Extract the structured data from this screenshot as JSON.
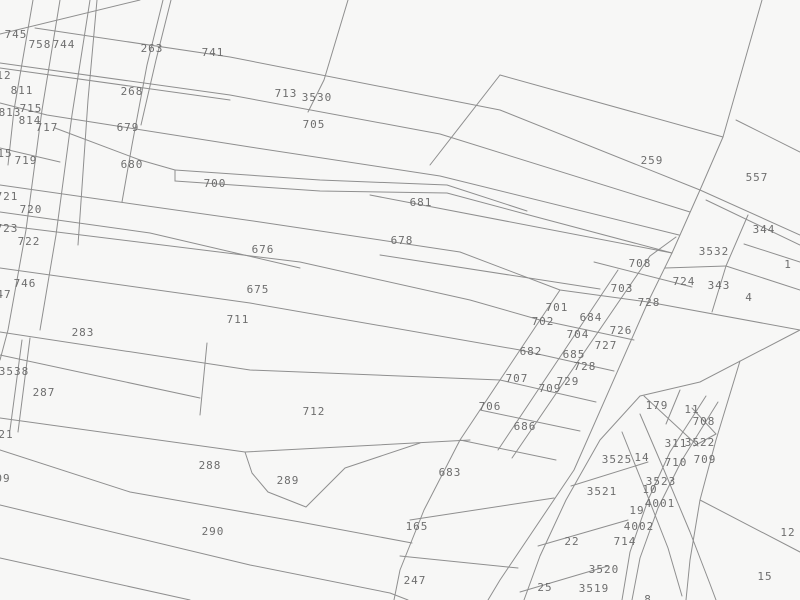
{
  "map": {
    "type": "cadastral-parcel-map",
    "colors": {
      "background": "#f7f7f6",
      "line": "#8f8f8f",
      "label": "#6e6e6e"
    },
    "labels": [
      {
        "t": "745",
        "x": 16,
        "y": 34
      },
      {
        "t": "758",
        "x": 40,
        "y": 44
      },
      {
        "t": "744",
        "x": 64,
        "y": 44
      },
      {
        "t": "12",
        "x": 4,
        "y": 75
      },
      {
        "t": "811",
        "x": 22,
        "y": 90
      },
      {
        "t": "715",
        "x": 31,
        "y": 108
      },
      {
        "t": "813",
        "x": 10,
        "y": 112
      },
      {
        "t": "814",
        "x": 30,
        "y": 120
      },
      {
        "t": "717",
        "x": 47,
        "y": 127
      },
      {
        "t": "263",
        "x": 152,
        "y": 48
      },
      {
        "t": "741",
        "x": 213,
        "y": 52
      },
      {
        "t": "268",
        "x": 132,
        "y": 91
      },
      {
        "t": "679",
        "x": 128,
        "y": 127
      },
      {
        "t": "713",
        "x": 286,
        "y": 93
      },
      {
        "t": "3530",
        "x": 317,
        "y": 97
      },
      {
        "t": "705",
        "x": 314,
        "y": 124
      },
      {
        "t": "15",
        "x": 5,
        "y": 153
      },
      {
        "t": "719",
        "x": 26,
        "y": 160
      },
      {
        "t": "680",
        "x": 132,
        "y": 164
      },
      {
        "t": "700",
        "x": 215,
        "y": 183
      },
      {
        "t": "721",
        "x": 7,
        "y": 196
      },
      {
        "t": "720",
        "x": 31,
        "y": 209
      },
      {
        "t": "723",
        "x": 7,
        "y": 228
      },
      {
        "t": "722",
        "x": 29,
        "y": 241
      },
      {
        "t": "746",
        "x": 25,
        "y": 283
      },
      {
        "t": "47",
        "x": 4,
        "y": 294
      },
      {
        "t": "681",
        "x": 421,
        "y": 202
      },
      {
        "t": "678",
        "x": 402,
        "y": 240
      },
      {
        "t": "676",
        "x": 263,
        "y": 249
      },
      {
        "t": "675",
        "x": 258,
        "y": 289
      },
      {
        "t": "711",
        "x": 238,
        "y": 319
      },
      {
        "t": "283",
        "x": 83,
        "y": 332
      },
      {
        "t": "3538",
        "x": 14,
        "y": 371
      },
      {
        "t": "287",
        "x": 44,
        "y": 392
      },
      {
        "t": "259",
        "x": 652,
        "y": 160
      },
      {
        "t": "557",
        "x": 757,
        "y": 177
      },
      {
        "t": "344",
        "x": 764,
        "y": 229
      },
      {
        "t": "3532",
        "x": 714,
        "y": 251
      },
      {
        "t": "708",
        "x": 640,
        "y": 263
      },
      {
        "t": "1",
        "x": 788,
        "y": 264
      },
      {
        "t": "724",
        "x": 684,
        "y": 281
      },
      {
        "t": "703",
        "x": 622,
        "y": 288
      },
      {
        "t": "343",
        "x": 719,
        "y": 285
      },
      {
        "t": "4",
        "x": 749,
        "y": 297
      },
      {
        "t": "728",
        "x": 649,
        "y": 302
      },
      {
        "t": "701",
        "x": 557,
        "y": 307
      },
      {
        "t": "684",
        "x": 591,
        "y": 317
      },
      {
        "t": "702",
        "x": 543,
        "y": 321
      },
      {
        "t": "726",
        "x": 621,
        "y": 330
      },
      {
        "t": "704",
        "x": 578,
        "y": 334
      },
      {
        "t": "727",
        "x": 606,
        "y": 345
      },
      {
        "t": "682",
        "x": 531,
        "y": 351
      },
      {
        "t": "685",
        "x": 574,
        "y": 354
      },
      {
        "t": "728",
        "x": 585,
        "y": 366
      },
      {
        "t": "707",
        "x": 517,
        "y": 378
      },
      {
        "t": "729",
        "x": 568,
        "y": 381
      },
      {
        "t": "709",
        "x": 550,
        "y": 388
      },
      {
        "t": "706",
        "x": 490,
        "y": 406
      },
      {
        "t": "686",
        "x": 525,
        "y": 426
      },
      {
        "t": "712",
        "x": 314,
        "y": 411
      },
      {
        "t": "288",
        "x": 210,
        "y": 465
      },
      {
        "t": "289",
        "x": 288,
        "y": 480
      },
      {
        "t": "683",
        "x": 450,
        "y": 472
      },
      {
        "t": "290",
        "x": 213,
        "y": 531
      },
      {
        "t": "165",
        "x": 417,
        "y": 526
      },
      {
        "t": "247",
        "x": 415,
        "y": 580
      },
      {
        "t": "21",
        "x": 6,
        "y": 434
      },
      {
        "t": "09",
        "x": 3,
        "y": 478
      },
      {
        "t": "179",
        "x": 657,
        "y": 405
      },
      {
        "t": "11",
        "x": 692,
        "y": 409
      },
      {
        "t": "708",
        "x": 704,
        "y": 421
      },
      {
        "t": "311",
        "x": 676,
        "y": 443
      },
      {
        "t": "3522",
        "x": 700,
        "y": 442
      },
      {
        "t": "3525",
        "x": 617,
        "y": 459
      },
      {
        "t": "14",
        "x": 642,
        "y": 457
      },
      {
        "t": "710",
        "x": 676,
        "y": 462
      },
      {
        "t": "709",
        "x": 705,
        "y": 459
      },
      {
        "t": "3523",
        "x": 661,
        "y": 481
      },
      {
        "t": "10",
        "x": 650,
        "y": 489
      },
      {
        "t": "3521",
        "x": 602,
        "y": 491
      },
      {
        "t": "4001",
        "x": 660,
        "y": 503
      },
      {
        "t": "19",
        "x": 637,
        "y": 510
      },
      {
        "t": "4002",
        "x": 639,
        "y": 526
      },
      {
        "t": "22",
        "x": 572,
        "y": 541
      },
      {
        "t": "714",
        "x": 625,
        "y": 541
      },
      {
        "t": "12",
        "x": 788,
        "y": 532
      },
      {
        "t": "3520",
        "x": 604,
        "y": 569
      },
      {
        "t": "15",
        "x": 765,
        "y": 576
      },
      {
        "t": "25",
        "x": 545,
        "y": 587
      },
      {
        "t": "3519",
        "x": 594,
        "y": 588
      },
      {
        "t": "8",
        "x": 648,
        "y": 599
      }
    ],
    "lines": [
      [
        33,
        0,
        14,
        110,
        8,
        165
      ],
      [
        60,
        0,
        42,
        110,
        26,
        230,
        8,
        330,
        0,
        360
      ],
      [
        90,
        0,
        72,
        115,
        56,
        235,
        40,
        330
      ],
      [
        97,
        0,
        88,
        100,
        78,
        245
      ],
      [
        163,
        0,
        147,
        65,
        132,
        145,
        122,
        202
      ],
      [
        171,
        0,
        156,
        60,
        141,
        125
      ],
      [
        348,
        0,
        324,
        80,
        308,
        112
      ],
      [
        0,
        34,
        140,
        0
      ],
      [
        35,
        28,
        230,
        57,
        500,
        110,
        700,
        190
      ],
      [
        0,
        63,
        230,
        95,
        440,
        134,
        690,
        212
      ],
      [
        0,
        68,
        230,
        100
      ],
      [
        0,
        103,
        47,
        115,
        250,
        147,
        440,
        176,
        679,
        235
      ],
      [
        55,
        128,
        140,
        160,
        175,
        170
      ],
      [
        175,
        170,
        320,
        180,
        447,
        185,
        527,
        211
      ],
      [
        175,
        181,
        320,
        191,
        447,
        193,
        529,
        215
      ],
      [
        175,
        170,
        175,
        181
      ],
      [
        529,
        215,
        672,
        253
      ],
      [
        370,
        195,
        672,
        253
      ],
      [
        0,
        148,
        60,
        162
      ],
      [
        0,
        185,
        260,
        222,
        460,
        252,
        560,
        290,
        648,
        302
      ],
      [
        0,
        212,
        150,
        233,
        300,
        268
      ],
      [
        0,
        225,
        300,
        262,
        470,
        300,
        540,
        320,
        634,
        340
      ],
      [
        0,
        268,
        250,
        303,
        520,
        350,
        614,
        371
      ],
      [
        0,
        332,
        250,
        370,
        500,
        380,
        596,
        402
      ],
      [
        380,
        255,
        600,
        289
      ],
      [
        0,
        355,
        200,
        398
      ],
      [
        22,
        340,
        10,
        430
      ],
      [
        30,
        338,
        18,
        432
      ],
      [
        207,
        343,
        200,
        415
      ],
      [
        0,
        418,
        245,
        452,
        470,
        440
      ],
      [
        245,
        452,
        252,
        473,
        268,
        492,
        306,
        507,
        345,
        468,
        420,
        443
      ],
      [
        0,
        450,
        130,
        492,
        300,
        522,
        412,
        543
      ],
      [
        0,
        505,
        250,
        565,
        390,
        593,
        408,
        600
      ],
      [
        0,
        558,
        190,
        600
      ],
      [
        460,
        440,
        424,
        510,
        400,
        570,
        394,
        600
      ],
      [
        410,
        520,
        554,
        498
      ],
      [
        400,
        556,
        518,
        568
      ],
      [
        648,
        302,
        574,
        470,
        500,
        580,
        488,
        600
      ],
      [
        762,
        0,
        723,
        137,
        700,
        190,
        672,
        253,
        648,
        302
      ],
      [
        500,
        75,
        723,
        137
      ],
      [
        500,
        75,
        430,
        165
      ],
      [
        736,
        120,
        800,
        152
      ],
      [
        700,
        190,
        800,
        235
      ],
      [
        706,
        200,
        800,
        245
      ],
      [
        665,
        268,
        726,
        266
      ],
      [
        748,
        215,
        726,
        266,
        712,
        312
      ],
      [
        726,
        266,
        800,
        290
      ],
      [
        744,
        244,
        800,
        262
      ],
      [
        648,
        302,
        800,
        330
      ],
      [
        800,
        330,
        700,
        382,
        640,
        396,
        600,
        440,
        566,
        500,
        540,
        556,
        524,
        600
      ],
      [
        740,
        361,
        716,
        440,
        700,
        500,
        690,
        560,
        686,
        600
      ],
      [
        700,
        500,
        800,
        552
      ],
      [
        560,
        290,
        460,
        440
      ],
      [
        618,
        270,
        498,
        450
      ],
      [
        650,
        256,
        512,
        458
      ],
      [
        650,
        256,
        676,
        237
      ],
      [
        594,
        262,
        692,
        287
      ],
      [
        480,
        410,
        580,
        431
      ],
      [
        460,
        440,
        556,
        460
      ],
      [
        706,
        396,
        670,
        452,
        648,
        500,
        630,
        552,
        622,
        600
      ],
      [
        718,
        402,
        682,
        460,
        658,
        508,
        640,
        558,
        632,
        600
      ],
      [
        640,
        414,
        664,
        470,
        690,
        532,
        710,
        584,
        716,
        600
      ],
      [
        622,
        432,
        646,
        492,
        668,
        548,
        682,
        596
      ],
      [
        571,
        486,
        648,
        462
      ],
      [
        538,
        546,
        628,
        520
      ],
      [
        520,
        592,
        608,
        566
      ],
      [
        680,
        390,
        666,
        424
      ],
      [
        692,
        408,
        716,
        434
      ],
      [
        716,
        434,
        694,
        446
      ],
      [
        644,
        396,
        698,
        446
      ]
    ]
  }
}
